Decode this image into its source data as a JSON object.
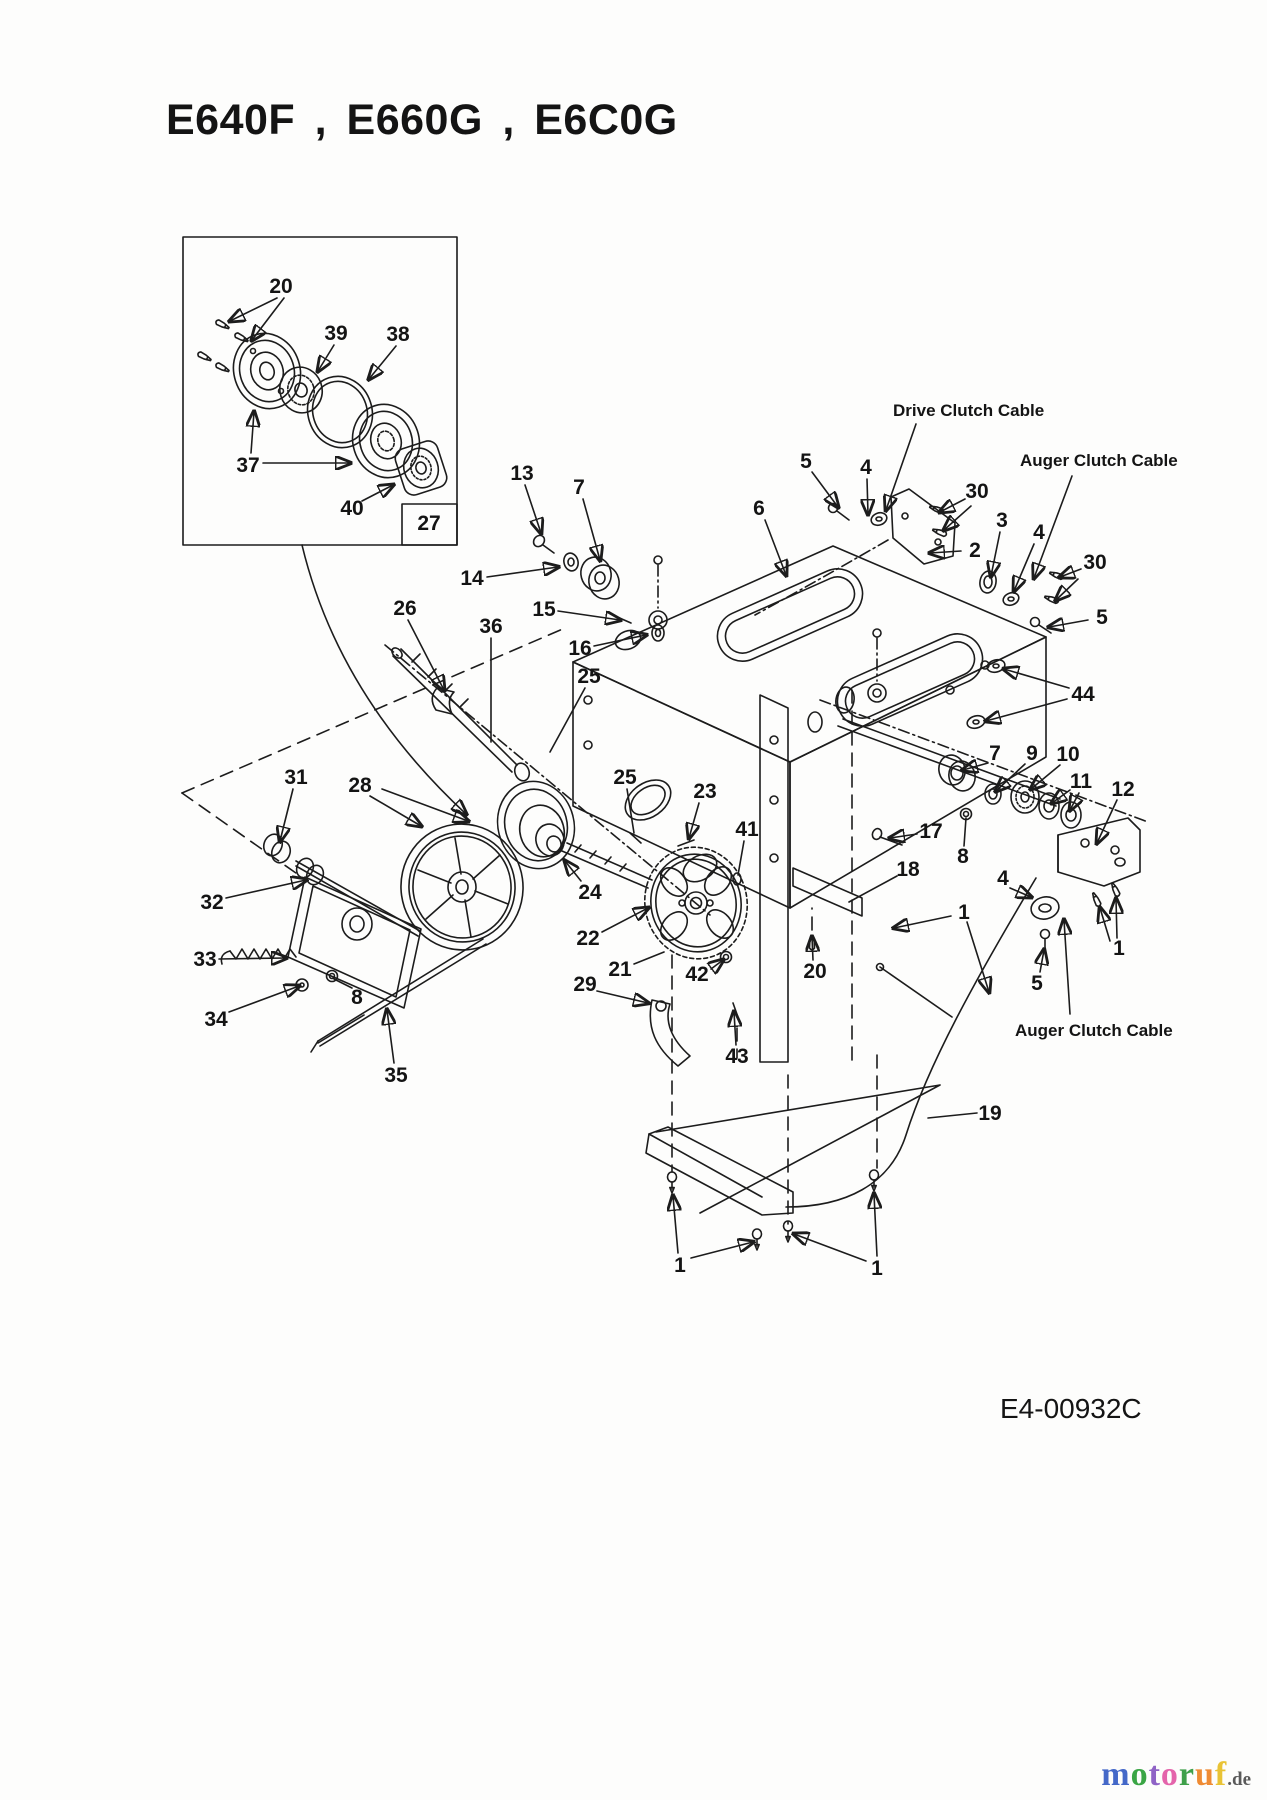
{
  "page": {
    "title": "E640F , E660G , E6C0G",
    "drawing_number": "E4-00932C",
    "inset_reference": "27",
    "ink_color": "#1c1c1c",
    "background_color": "#fdfdfc",
    "watermark": {
      "letters": [
        {
          "ch": "m",
          "color": "#4468c8"
        },
        {
          "ch": "o",
          "color": "#3aa545"
        },
        {
          "ch": "t",
          "color": "#8f63c6"
        },
        {
          "ch": "o",
          "color": "#e464ab"
        },
        {
          "ch": "r",
          "color": "#3fa04a"
        },
        {
          "ch": "u",
          "color": "#ef8b33"
        },
        {
          "ch": "f",
          "color": "#e9c335"
        }
      ],
      "suffix": ".de",
      "suffix_color": "#5a5a5a"
    }
  },
  "labels": [
    {
      "text": "Drive Clutch Cable",
      "x": 893,
      "y": 416,
      "cls": "lbl",
      "arrows": [
        [
          916,
          424,
          886,
          510
        ]
      ]
    },
    {
      "text": "Auger Clutch Cable",
      "x": 1020,
      "y": 466,
      "cls": "lbl",
      "arrows": [
        [
          1072,
          476,
          1034,
          578
        ]
      ]
    },
    {
      "text": "Auger Clutch Cable",
      "x": 1015,
      "y": 1036,
      "cls": "lbl",
      "arrows": [
        [
          1070,
          1014,
          1064,
          920
        ]
      ]
    },
    {
      "text": "E4-00932C",
      "x": 1000,
      "y": 1418,
      "cls": "dnum",
      "arrows": []
    }
  ],
  "callouts": [
    {
      "n": "20",
      "x": 281,
      "y": 286,
      "a": [
        [
          277,
          298,
          230,
          321
        ],
        [
          284,
          298,
          252,
          340
        ]
      ]
    },
    {
      "n": "39",
      "x": 336,
      "y": 333,
      "a": [
        [
          334,
          345,
          318,
          371
        ]
      ]
    },
    {
      "n": "38",
      "x": 398,
      "y": 334,
      "a": [
        [
          396,
          346,
          369,
          379
        ]
      ]
    },
    {
      "n": "37",
      "x": 248,
      "y": 465,
      "a": [
        [
          251,
          453,
          254,
          412
        ],
        [
          263,
          463,
          350,
          463
        ]
      ]
    },
    {
      "n": "40",
      "x": 352,
      "y": 508,
      "a": [
        [
          362,
          501,
          393,
          485
        ]
      ]
    },
    {
      "n": "27",
      "x": 429,
      "y": 523,
      "a": []
    },
    {
      "n": "13",
      "x": 522,
      "y": 473,
      "a": [
        [
          525,
          485,
          541,
          533
        ]
      ]
    },
    {
      "n": "7",
      "x": 579,
      "y": 487,
      "a": [
        [
          583,
          499,
          600,
          560
        ]
      ]
    },
    {
      "n": "14",
      "x": 472,
      "y": 578,
      "a": [
        [
          487,
          577,
          558,
          567
        ]
      ]
    },
    {
      "n": "15",
      "x": 544,
      "y": 609,
      "a": [
        [
          558,
          611,
          620,
          620
        ]
      ]
    },
    {
      "n": "16",
      "x": 580,
      "y": 648,
      "a": [
        [
          594,
          646,
          646,
          635
        ]
      ]
    },
    {
      "n": "26",
      "x": 405,
      "y": 608,
      "a": [
        [
          408,
          620,
          444,
          690
        ]
      ]
    },
    {
      "n": "36",
      "x": 491,
      "y": 626,
      "plain": true,
      "a": [
        [
          491,
          638,
          491,
          742
        ]
      ]
    },
    {
      "n": "25",
      "x": 589,
      "y": 676,
      "plain": true,
      "a": [
        [
          585,
          688,
          550,
          752
        ]
      ]
    },
    {
      "n": "6",
      "x": 759,
      "y": 508,
      "a": [
        [
          765,
          520,
          786,
          575
        ]
      ]
    },
    {
      "n": "5",
      "x": 806,
      "y": 461,
      "a": [
        [
          812,
          472,
          838,
          507
        ]
      ]
    },
    {
      "n": "4",
      "x": 866,
      "y": 467,
      "a": [
        [
          867,
          479,
          868,
          514
        ]
      ]
    },
    {
      "n": "30",
      "x": 977,
      "y": 491,
      "a": [
        [
          965,
          499,
          940,
          512
        ],
        [
          971,
          506,
          944,
          530
        ]
      ]
    },
    {
      "n": "3",
      "x": 1002,
      "y": 520,
      "a": [
        [
          1000,
          532,
          991,
          576
        ]
      ]
    },
    {
      "n": "2",
      "x": 975,
      "y": 550,
      "a": [
        [
          961,
          551,
          930,
          553
        ]
      ]
    },
    {
      "n": "4",
      "x": 1039,
      "y": 532,
      "a": [
        [
          1034,
          544,
          1014,
          591
        ]
      ]
    },
    {
      "n": "30",
      "x": 1095,
      "y": 562,
      "a": [
        [
          1081,
          569,
          1060,
          577
        ],
        [
          1078,
          579,
          1056,
          600
        ]
      ]
    },
    {
      "n": "5",
      "x": 1102,
      "y": 617,
      "a": [
        [
          1088,
          620,
          1049,
          627
        ]
      ]
    },
    {
      "n": "44",
      "x": 1083,
      "y": 694,
      "a": [
        [
          1069,
          688,
          1004,
          669
        ],
        [
          1067,
          699,
          986,
          721
        ]
      ]
    },
    {
      "n": "7",
      "x": 995,
      "y": 753,
      "a": [
        [
          988,
          763,
          963,
          770
        ]
      ]
    },
    {
      "n": "9",
      "x": 1032,
      "y": 753,
      "a": [
        [
          1025,
          764,
          996,
          791
        ]
      ]
    },
    {
      "n": "10",
      "x": 1068,
      "y": 754,
      "a": [
        [
          1060,
          765,
          1031,
          789
        ]
      ]
    },
    {
      "n": "11",
      "x": 1081,
      "y": 781,
      "a": [
        [
          1070,
          790,
          1052,
          803
        ],
        [
          1079,
          793,
          1070,
          810
        ]
      ]
    },
    {
      "n": "12",
      "x": 1123,
      "y": 789,
      "a": [
        [
          1117,
          800,
          1097,
          843
        ]
      ]
    },
    {
      "n": "17",
      "x": 931,
      "y": 831,
      "a": [
        [
          917,
          834,
          890,
          838
        ]
      ]
    },
    {
      "n": "8",
      "x": 963,
      "y": 856,
      "plain": true,
      "a": [
        [
          964,
          846,
          966,
          818
        ]
      ]
    },
    {
      "n": "18",
      "x": 908,
      "y": 869,
      "plain": true,
      "a": [
        [
          897,
          876,
          849,
          902
        ]
      ]
    },
    {
      "n": "4",
      "x": 1003,
      "y": 878,
      "a": [
        [
          1010,
          888,
          1031,
          897
        ]
      ]
    },
    {
      "n": "1",
      "x": 964,
      "y": 912,
      "a": [
        [
          951,
          916,
          894,
          928
        ],
        [
          967,
          922,
          989,
          992
        ]
      ]
    },
    {
      "n": "1",
      "x": 1119,
      "y": 948,
      "a": [
        [
          1117,
          938,
          1116,
          899
        ],
        [
          1110,
          941,
          1100,
          908
        ]
      ]
    },
    {
      "n": "5",
      "x": 1037,
      "y": 983,
      "a": [
        [
          1040,
          972,
          1044,
          950
        ]
      ]
    },
    {
      "n": "19",
      "x": 990,
      "y": 1113,
      "plain": true,
      "a": [
        [
          977,
          1113,
          928,
          1118
        ]
      ]
    },
    {
      "n": "31",
      "x": 296,
      "y": 777,
      "a": [
        [
          293,
          789,
          280,
          841
        ]
      ]
    },
    {
      "n": "28",
      "x": 360,
      "y": 785,
      "a": [
        [
          370,
          796,
          421,
          826
        ],
        [
          382,
          789,
          468,
          821
        ]
      ]
    },
    {
      "n": "32",
      "x": 212,
      "y": 902,
      "a": [
        [
          226,
          898,
          306,
          880
        ]
      ]
    },
    {
      "n": "33",
      "x": 205,
      "y": 959,
      "a": [
        [
          219,
          959,
          286,
          958
        ]
      ]
    },
    {
      "n": "34",
      "x": 216,
      "y": 1019,
      "a": [
        [
          229,
          1012,
          299,
          986
        ]
      ]
    },
    {
      "n": "8",
      "x": 357,
      "y": 997,
      "plain": true,
      "a": [
        [
          352,
          988,
          334,
          979
        ]
      ]
    },
    {
      "n": "35",
      "x": 396,
      "y": 1075,
      "a": [
        [
          394,
          1063,
          387,
          1010
        ]
      ]
    },
    {
      "n": "24",
      "x": 590,
      "y": 892,
      "a": [
        [
          581,
          881,
          565,
          861
        ]
      ]
    },
    {
      "n": "25",
      "x": 625,
      "y": 777,
      "plain": true,
      "a": [
        [
          627,
          789,
          634,
          833
        ]
      ]
    },
    {
      "n": "23",
      "x": 705,
      "y": 791,
      "a": [
        [
          699,
          803,
          689,
          838
        ]
      ]
    },
    {
      "n": "41",
      "x": 747,
      "y": 829,
      "plain": true,
      "a": [
        [
          744,
          841,
          738,
          875
        ]
      ]
    },
    {
      "n": "22",
      "x": 588,
      "y": 938,
      "a": [
        [
          602,
          932,
          648,
          908
        ]
      ]
    },
    {
      "n": "21",
      "x": 620,
      "y": 969,
      "plain": true,
      "a": [
        [
          634,
          964,
          664,
          952
        ]
      ]
    },
    {
      "n": "42",
      "x": 697,
      "y": 974,
      "a": [
        [
          711,
          969,
          723,
          960
        ]
      ]
    },
    {
      "n": "29",
      "x": 585,
      "y": 984,
      "a": [
        [
          597,
          991,
          648,
          1003
        ]
      ]
    },
    {
      "n": "20",
      "x": 815,
      "y": 971,
      "a": [
        [
          813,
          960,
          812,
          937
        ]
      ]
    },
    {
      "n": "43",
      "x": 737,
      "y": 1056,
      "a": [
        [
          736,
          1045,
          734,
          1012
        ]
      ]
    },
    {
      "n": "1",
      "x": 680,
      "y": 1265,
      "a": [
        [
          678,
          1253,
          673,
          1196
        ],
        [
          691,
          1258,
          753,
          1242
        ]
      ]
    },
    {
      "n": "1",
      "x": 877,
      "y": 1268,
      "a": [
        [
          877,
          1256,
          874,
          1194
        ],
        [
          866,
          1261,
          794,
          1234
        ]
      ]
    }
  ]
}
